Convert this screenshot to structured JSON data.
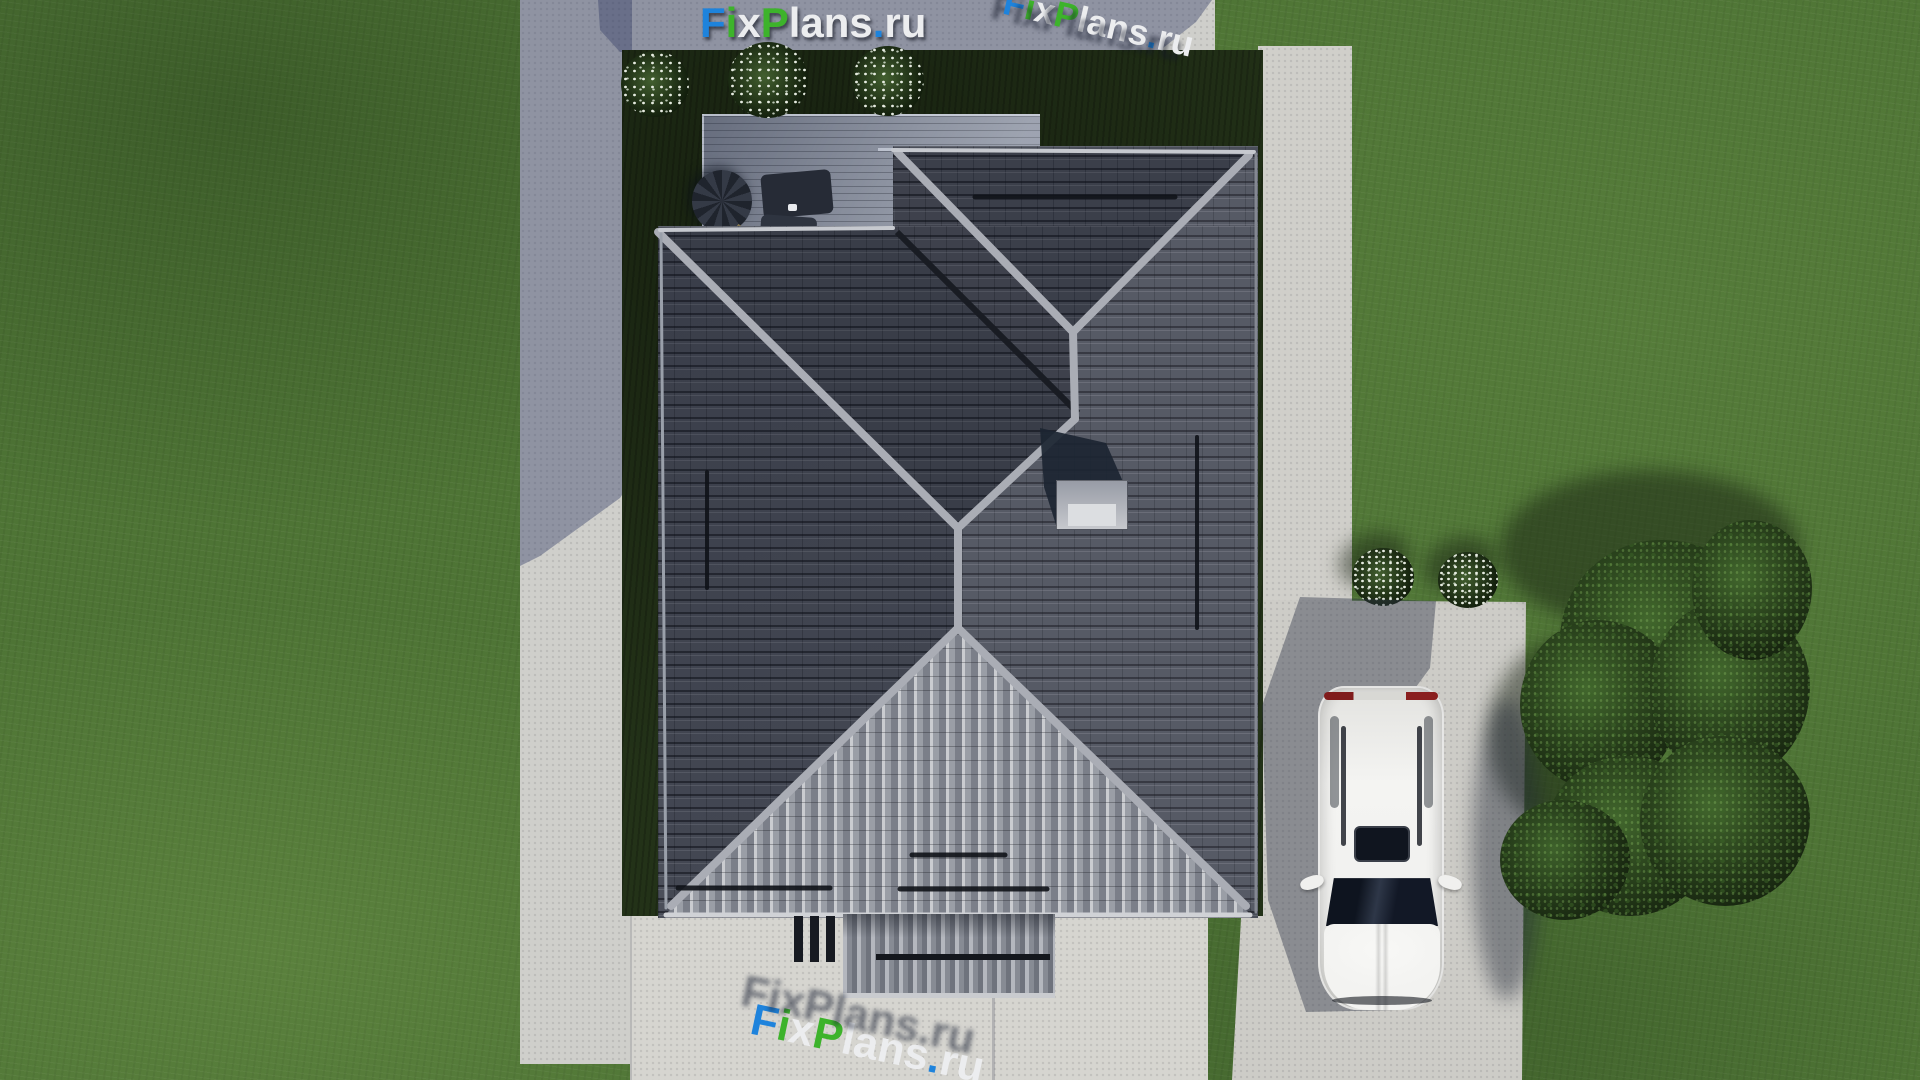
{
  "watermark": {
    "text": "FixPlans.ru",
    "letters": [
      {
        "ch": "F",
        "c": "blue"
      },
      {
        "ch": "i",
        "c": "green"
      },
      {
        "ch": "x",
        "c": "white"
      },
      {
        "ch": "P",
        "c": "green"
      },
      {
        "ch": "l",
        "c": "white"
      },
      {
        "ch": "a",
        "c": "white"
      },
      {
        "ch": "n",
        "c": "white"
      },
      {
        "ch": "s",
        "c": "white"
      },
      {
        "ch": ".",
        "c": "blue"
      },
      {
        "ch": "r",
        "c": "white"
      },
      {
        "ch": "u",
        "c": "white"
      }
    ]
  },
  "palette": {
    "blue": "#1e83dc",
    "green": "#3db32b",
    "white": "#ecedef",
    "grass": "#4e7435",
    "garden_bed": "#233218",
    "concrete_lit": "#cfcfcb",
    "concrete_shadow": "#8d92a4",
    "roof_tiles": "#4b4f5a",
    "roof_ridge": "#aaadb5",
    "roof_sunlit_face": "#caccd0",
    "deck": "#8d93a1",
    "chimney": "#b5b8bf",
    "chimney_shadow": "#1c2532",
    "car": "#f3f3f1",
    "taillight_red": "#8a1f1f"
  },
  "scene": {
    "description": "Top-down aerial 3D render of a single-family house with a dark hipped tile roof, wooden terrace with patio furniture, lawn, concrete walkways, driveway with a parked white SUV, trees and white flower bushes",
    "objects": [
      "lawn",
      "concrete-walkway-ring",
      "garden-bed",
      "terrace-deck",
      "patio-furniture",
      "flower-bushes",
      "hip-roof",
      "chimney",
      "snow-guards",
      "porch-roof",
      "driveway",
      "white-suv",
      "trees",
      "watermarks"
    ]
  }
}
